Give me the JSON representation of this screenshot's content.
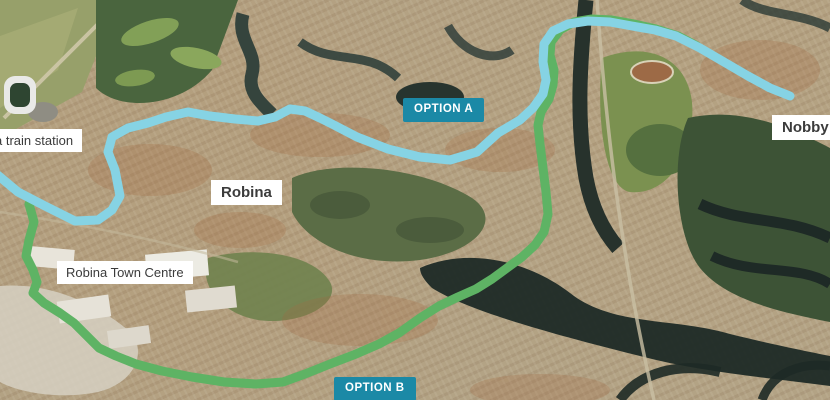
{
  "map": {
    "labels": {
      "train_station": "a train station",
      "robina": "Robina",
      "robina_town_centre": "Robina Town Centre",
      "nobby_beach": "Nobby Be"
    },
    "badge_color": "#1b89a6",
    "label_style": {
      "bg": "#ffffff",
      "text": "#3b3b3b"
    },
    "routes": {
      "option_b": {
        "badge": "OPTION B",
        "color": "#5eb364",
        "width": 9,
        "points": [
          [
            29,
            204
          ],
          [
            34,
            222
          ],
          [
            29,
            240
          ],
          [
            26,
            256
          ],
          [
            33,
            270
          ],
          [
            37,
            282
          ],
          [
            33,
            293
          ],
          [
            44,
            303
          ],
          [
            60,
            313
          ],
          [
            74,
            323
          ],
          [
            87,
            336
          ],
          [
            99,
            348
          ],
          [
            116,
            356
          ],
          [
            136,
            364
          ],
          [
            162,
            371
          ],
          [
            192,
            377
          ],
          [
            224,
            382
          ],
          [
            256,
            384
          ],
          [
            283,
            382
          ],
          [
            305,
            374
          ],
          [
            330,
            364
          ],
          [
            356,
            354
          ],
          [
            379,
            344
          ],
          [
            399,
            333
          ],
          [
            420,
            318
          ],
          [
            439,
            306
          ],
          [
            458,
            297
          ],
          [
            476,
            289
          ],
          [
            492,
            279
          ],
          [
            507,
            268
          ],
          [
            522,
            257
          ],
          [
            535,
            245
          ],
          [
            544,
            232
          ],
          [
            548,
            214
          ],
          [
            546,
            192
          ],
          [
            543,
            168
          ],
          [
            540,
            144
          ],
          [
            538,
            125
          ],
          [
            541,
            112
          ],
          [
            549,
            99
          ],
          [
            553,
            85
          ],
          [
            554,
            70
          ],
          [
            550,
            55
          ],
          [
            551,
            42
          ],
          [
            560,
            30
          ],
          [
            574,
            22
          ],
          [
            592,
            19
          ],
          [
            612,
            20
          ],
          [
            634,
            24
          ],
          [
            656,
            29
          ],
          [
            678,
            36
          ],
          [
            697,
            46
          ]
        ]
      },
      "option_a": {
        "badge": "OPTION A",
        "color": "#86d3e4",
        "width": 9,
        "points": [
          [
            -6,
            172
          ],
          [
            18,
            192
          ],
          [
            45,
            206
          ],
          [
            75,
            221
          ],
          [
            98,
            220
          ],
          [
            112,
            210
          ],
          [
            120,
            196
          ],
          [
            115,
            170
          ],
          [
            108,
            152
          ],
          [
            112,
            137
          ],
          [
            128,
            128
          ],
          [
            148,
            123
          ],
          [
            166,
            117
          ],
          [
            188,
            112
          ],
          [
            210,
            116
          ],
          [
            235,
            119
          ],
          [
            258,
            121
          ],
          [
            275,
            117
          ],
          [
            290,
            109
          ],
          [
            305,
            111
          ],
          [
            320,
            118
          ],
          [
            332,
            124
          ],
          [
            357,
            137
          ],
          [
            388,
            149
          ],
          [
            420,
            157
          ],
          [
            450,
            160
          ],
          [
            477,
            152
          ],
          [
            498,
            133
          ],
          [
            520,
            120
          ],
          [
            533,
            108
          ],
          [
            543,
            94
          ],
          [
            546,
            80
          ],
          [
            543,
            62
          ],
          [
            544,
            44
          ],
          [
            553,
            31
          ],
          [
            568,
            24
          ],
          [
            588,
            21
          ],
          [
            610,
            22
          ],
          [
            632,
            26
          ],
          [
            655,
            30
          ],
          [
            676,
            36
          ],
          [
            700,
            48
          ],
          [
            724,
            62
          ],
          [
            748,
            76
          ],
          [
            770,
            88
          ],
          [
            790,
            96
          ]
        ]
      }
    }
  }
}
